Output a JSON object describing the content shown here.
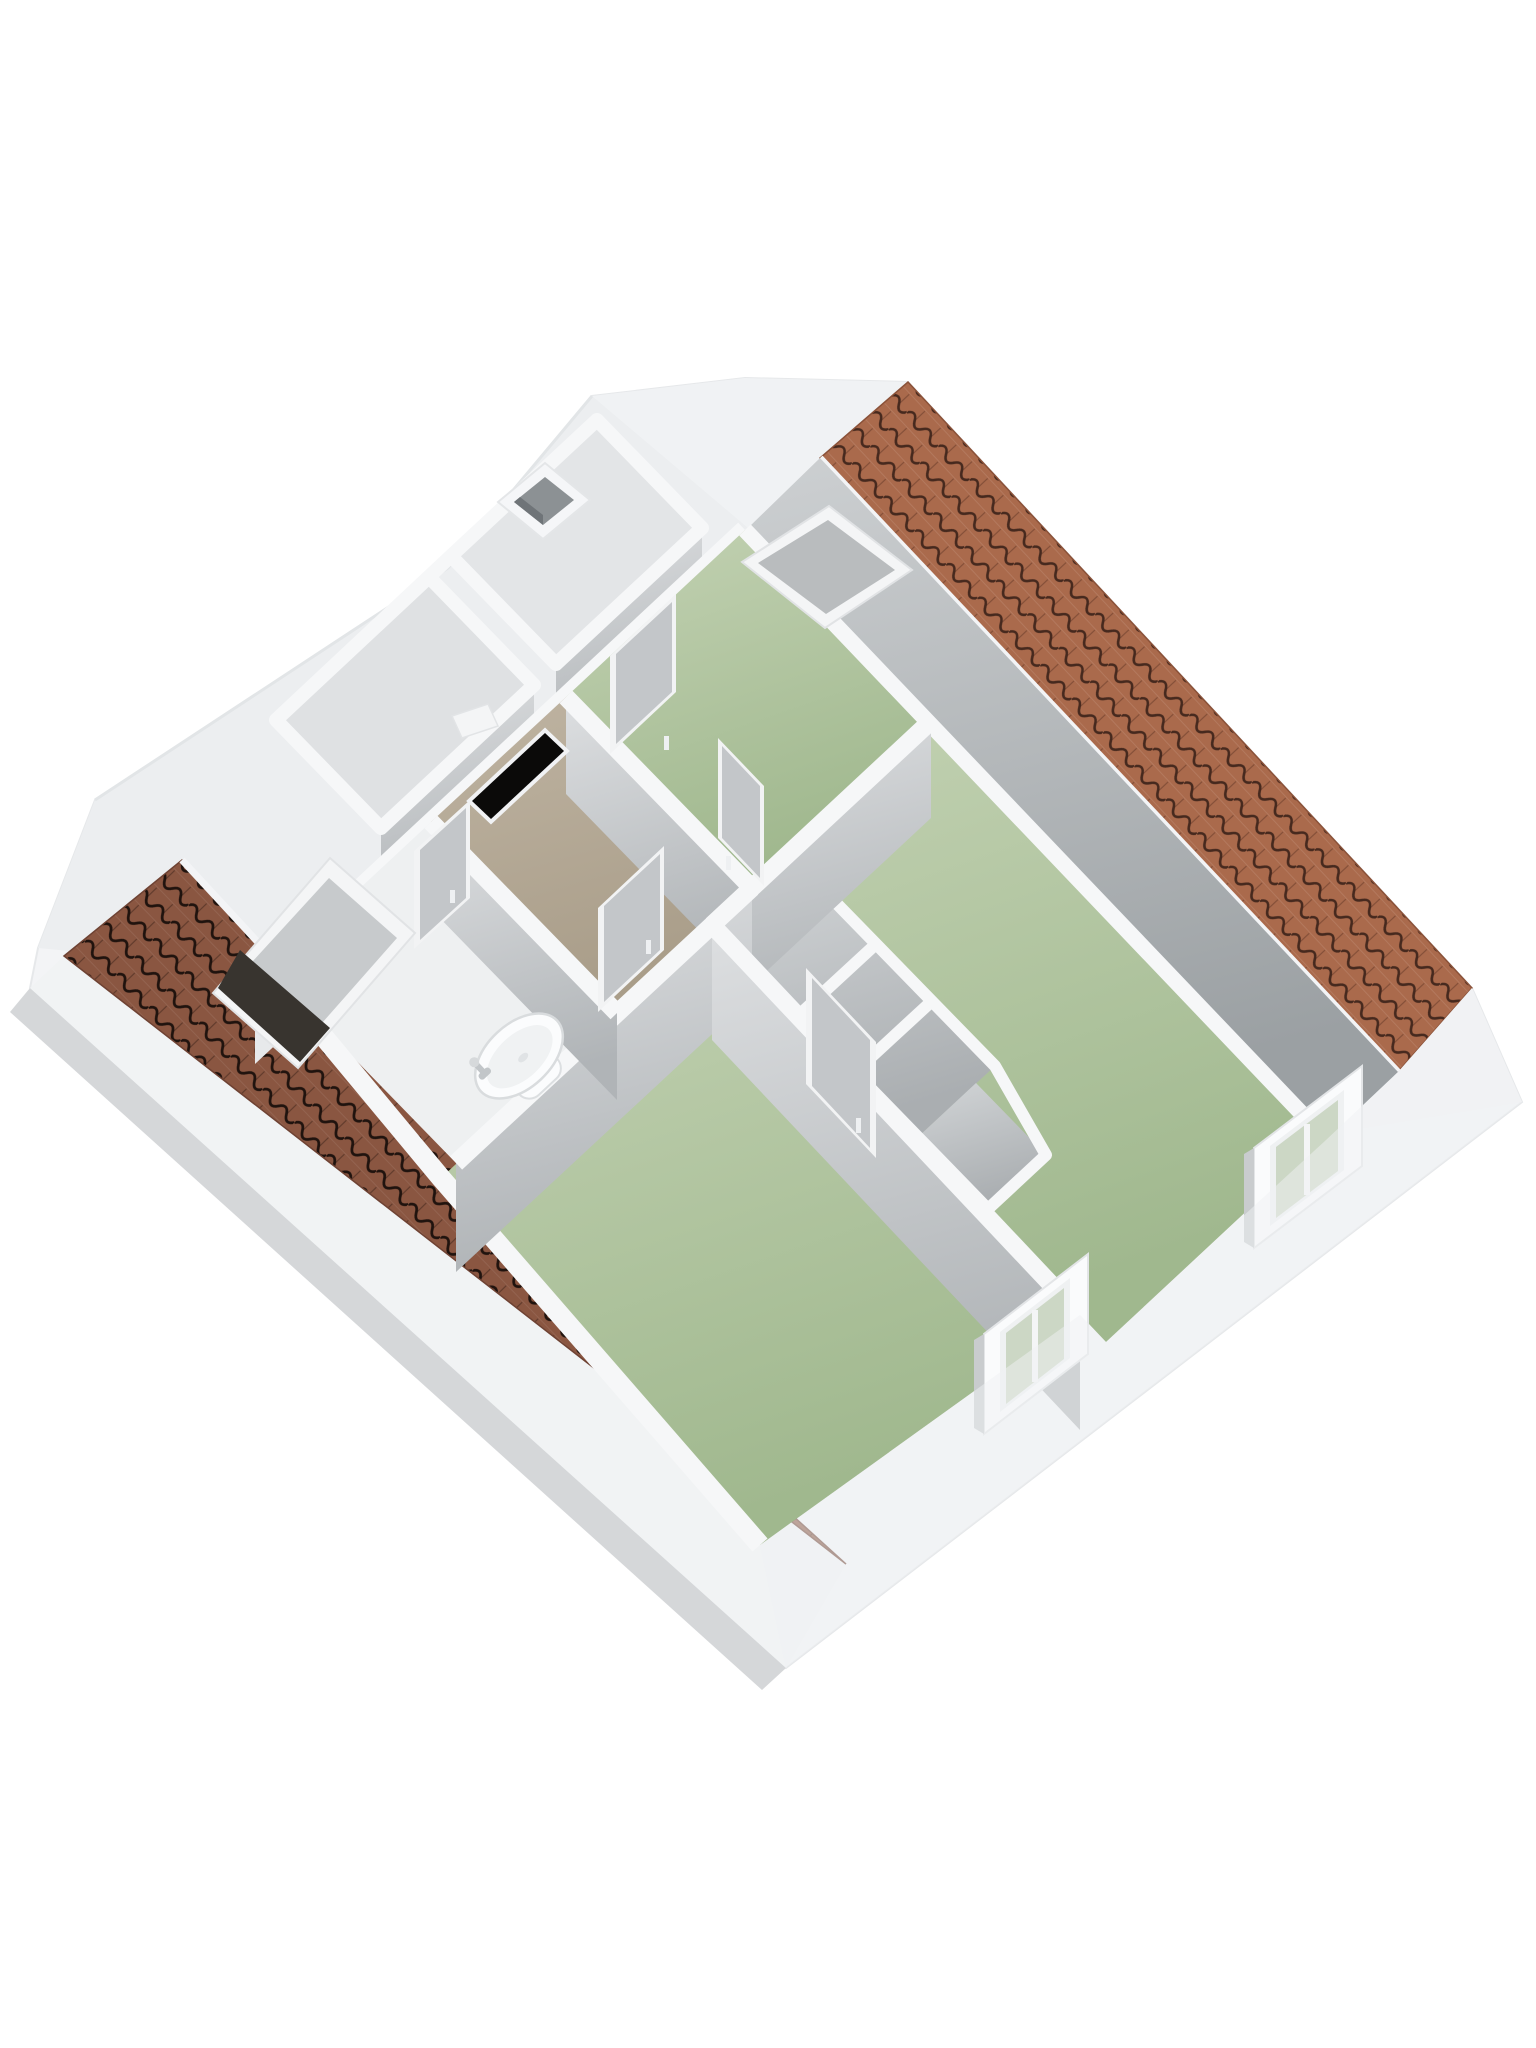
{
  "scene": {
    "type": "3d-floorplan-render",
    "description": "Isometric 3D cutaway render of an attic storey floor plan, viewed from above at a diagonal angle; no text labels on screen",
    "background": "#ffffff"
  },
  "colors": {
    "bg": "#ffffff",
    "shell": "#f3f4f6",
    "shell-shade": "#eceef0",
    "shell-line": "#e0e3e5",
    "slope-gray": "#b4b8bb",
    "wallface": "#c8cbce",
    "walltop": "#f6f7f8",
    "floor-green": "#aac29a",
    "floor-tan": "#b2a794",
    "floor-gray": "#c4c7ca",
    "floor-white": "#eef0f1",
    "tile-ne": "#aa6a4c",
    "tile-ne-line": "#46291e",
    "tile-sw": "#8a5641",
    "tile-sw-line": "#20130e",
    "stairwell": "#0b0a09",
    "skylight-frame": "#f4f5f6",
    "skylight-glass": "#b9bcbe",
    "skylight-dark": "#38342f",
    "window-glass": "#ccd7c5",
    "door-panel": "#c3c6c9",
    "door-frame": "#f2f3f4",
    "sink": "#fbfcfd",
    "sink-shade": "#d7dadc",
    "faucet": "#c2c6c9"
  },
  "rooms": [
    {
      "id": "room-top",
      "floor": "green",
      "features": [
        "skylight-closed",
        "sloped-gray-ceiling"
      ]
    },
    {
      "id": "room-right",
      "floor": "green",
      "features": [
        "facade-window",
        "built-in-closets"
      ]
    },
    {
      "id": "room-bottom-left",
      "floor": "green",
      "features": [
        "facade-window",
        "knee-wall"
      ]
    },
    {
      "id": "hallway-landing",
      "floor": "tan",
      "features": [
        "stairwell-opening"
      ]
    },
    {
      "id": "bathroom",
      "floor": "white",
      "features": [
        "washbasin",
        "skylight-open"
      ]
    },
    {
      "id": "storage-left-1",
      "floor": "gray",
      "features": []
    },
    {
      "id": "storage-left-2",
      "floor": "gray",
      "features": []
    },
    {
      "id": "closet-band",
      "floor": "gray",
      "compartments": 3
    }
  ],
  "roof": {
    "north_east_strip": {
      "tiles": "orange-terracotta",
      "ridge": "white"
    },
    "south_west_strip": {
      "tiles": "dark-terracotta",
      "eave": "white"
    }
  },
  "fixtures": {
    "skylights": 2,
    "facade_windows": 2,
    "doors": 5,
    "chimney": 1,
    "stairwell_openings": 1,
    "washbasins": 1
  }
}
